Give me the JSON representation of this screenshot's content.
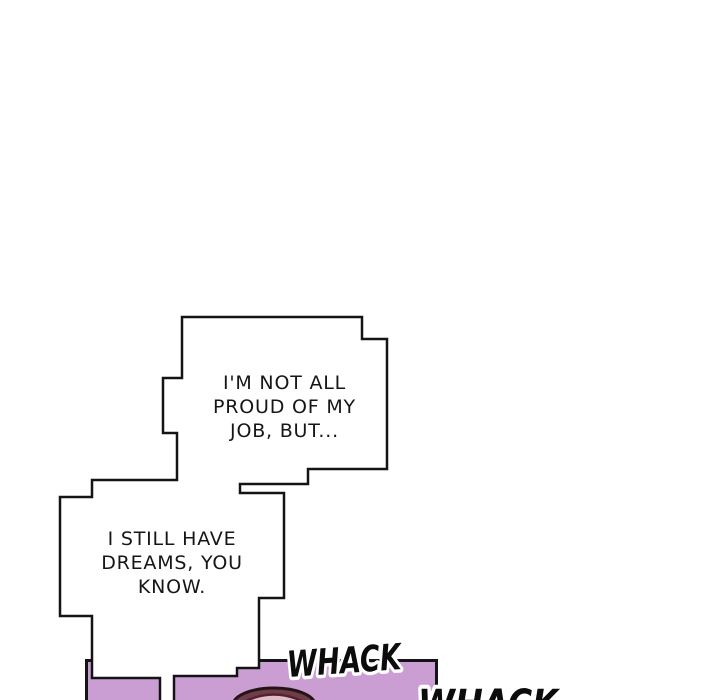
{
  "dialogue": {
    "bubble1": {
      "line1": "I'M NOT ALL",
      "line2": "PROUD OF MY",
      "line3": "JOB, BUT..."
    },
    "bubble2": {
      "line1": "I STILL HAVE",
      "line2": "DREAMS, YOU",
      "line3": "KNOW."
    }
  },
  "sfx": {
    "whack_main": "WHACK",
    "whack_partial": "WHACK"
  },
  "colors": {
    "page_background": "#ffffff",
    "line_ink": "#141414",
    "panel_fill": "#cb9ed3",
    "bubble_fill": "#ffffff",
    "sfx_fill": "#0c0c0c",
    "sfx_outline": "#ffffff",
    "head_base": "#6e3d49",
    "head_highlight": "#e0bccb",
    "head_streak": "#51242e",
    "head_outline": "#241418"
  }
}
